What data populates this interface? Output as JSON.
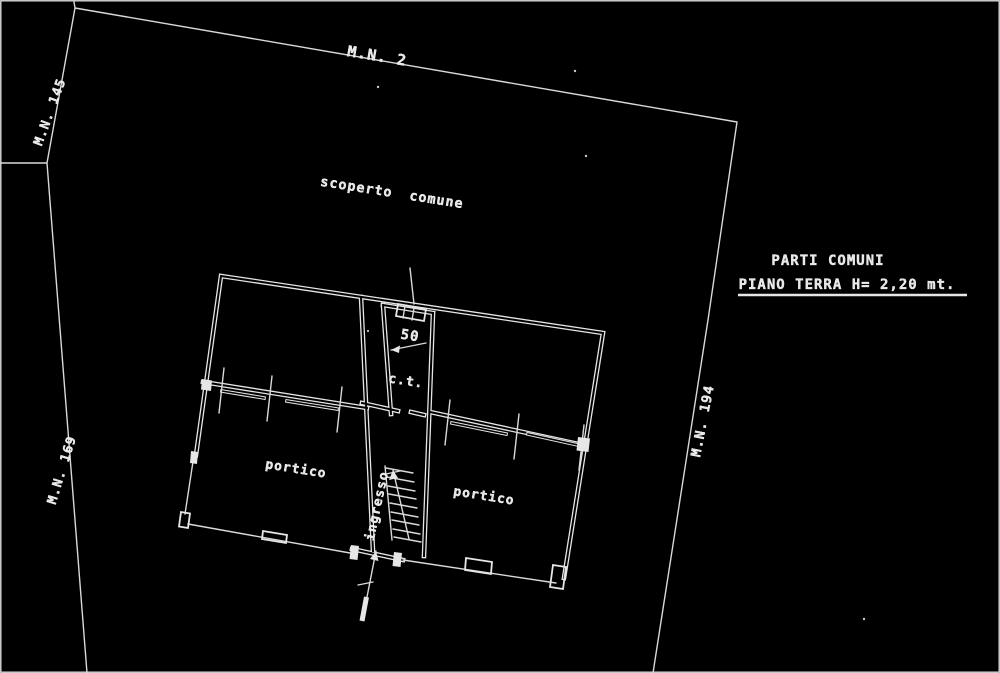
{
  "colors": {
    "background": "#000000",
    "line": "#e6e6e6"
  },
  "boundary_labels": {
    "top": "M.N. 2",
    "upper_left": "M.N. 145",
    "lower_left": "M.N. 169",
    "right": "M.N. 194"
  },
  "area_label": "scoperto comune",
  "legend": {
    "line1": "PARTI COMUNI",
    "line2": "PIANO TERRA  H= 2,20 mt."
  },
  "rooms": {
    "portico_left": "portico",
    "portico_right": "portico",
    "ct": "c.t.",
    "ingresso": "ingresso"
  },
  "dimensions": {
    "width_50": "50"
  }
}
